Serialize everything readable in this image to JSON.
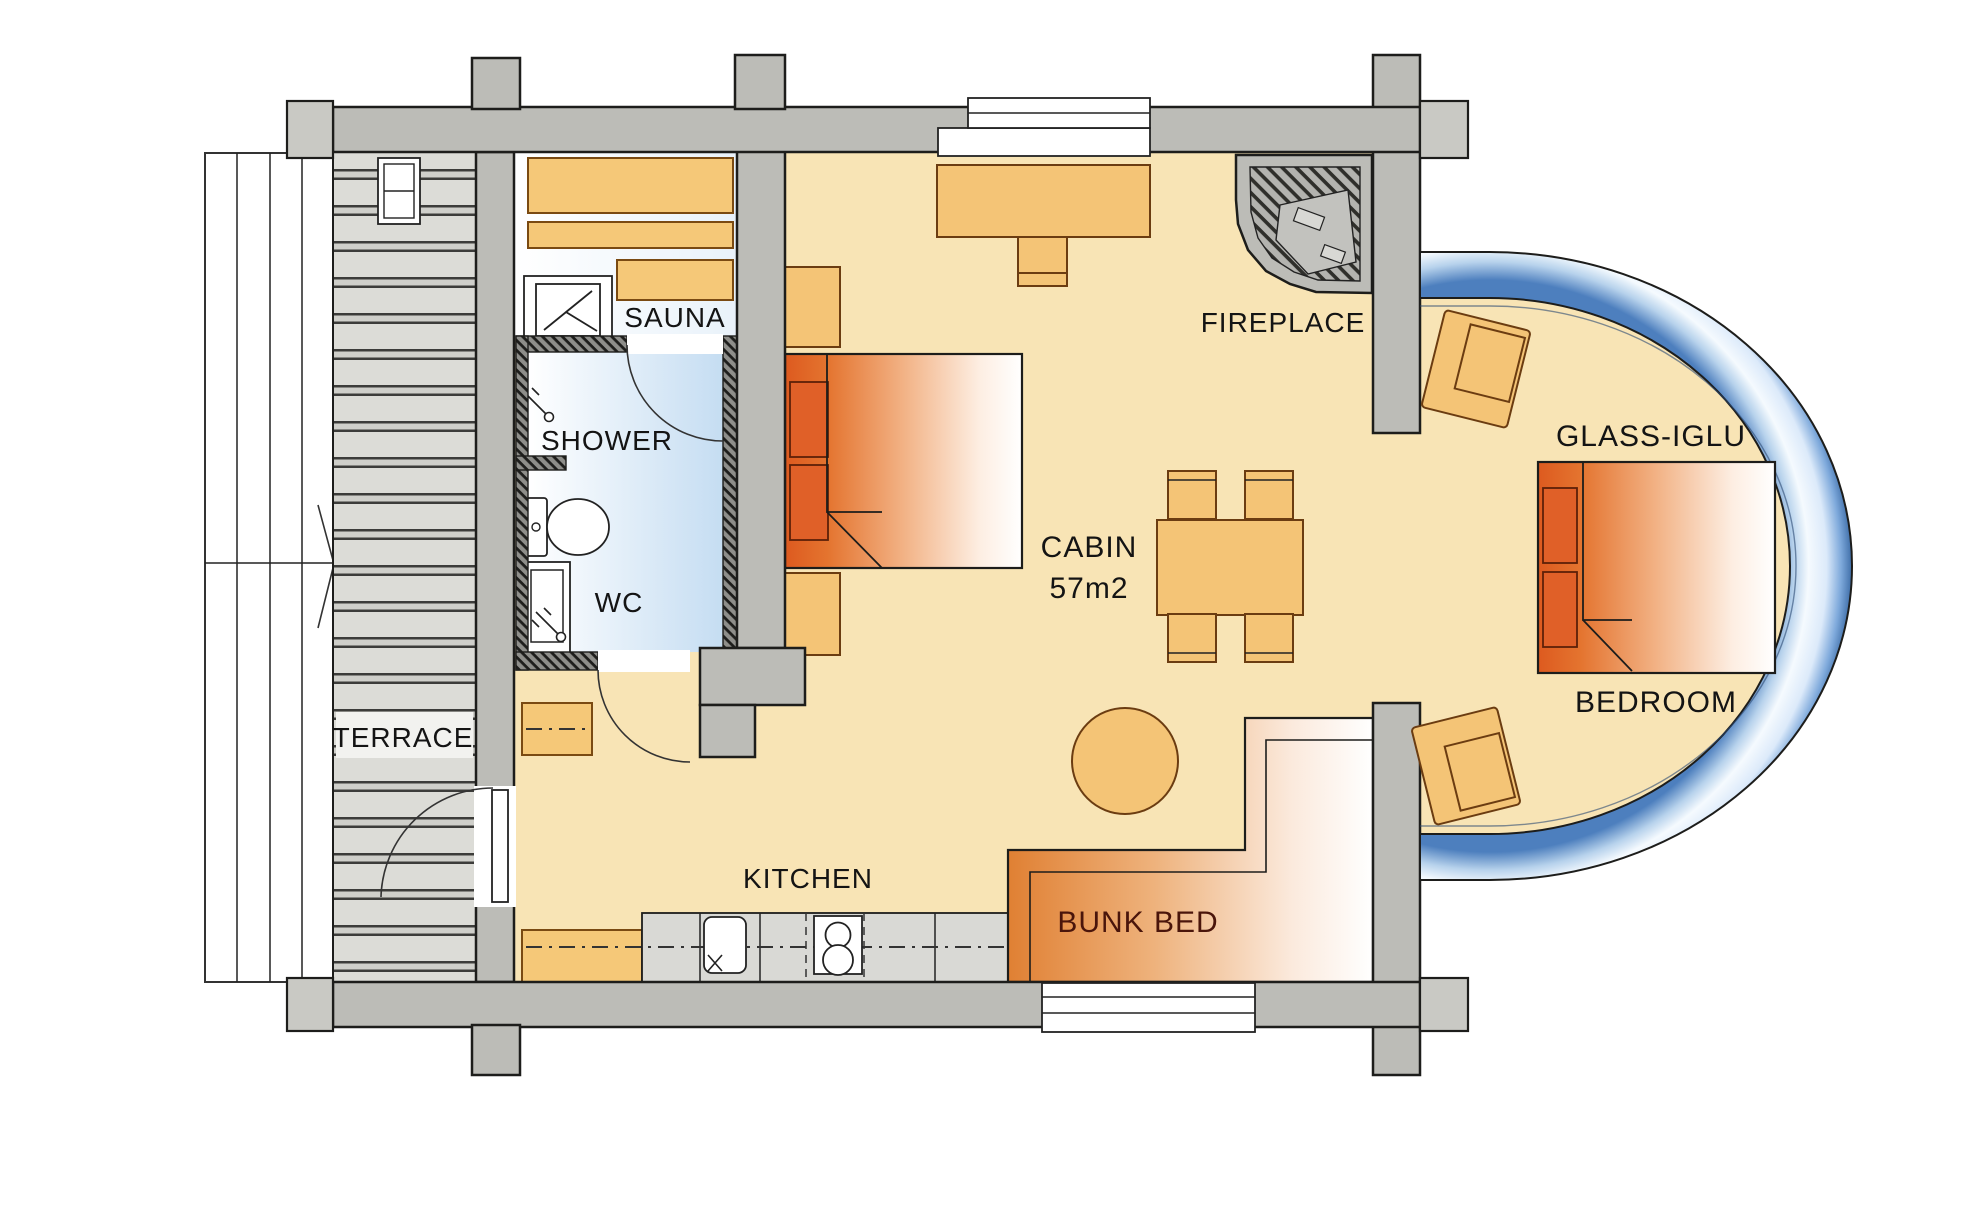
{
  "title": "Log cabin floor plan",
  "palette": {
    "wall": "#bcbcb7",
    "wallcap": "#c9c9c4",
    "outline": "#1d1d1b",
    "floor": "#f8e4b5",
    "terrace_plank": "#dcdcd7",
    "counter": "#d9d9d5",
    "furniture": "#f4c476",
    "benchwood": "#f5c878",
    "bathroom_blue": "#cfe4f5",
    "glass_blue": "#4d7fbe",
    "bed_orange": "#df5c20",
    "bunktext": "#4a150b",
    "label": "#141414"
  },
  "rooms": {
    "cabin_area_value": "57m2"
  },
  "labels": {
    "sauna": "SAUNA",
    "shower": "SHOWER",
    "wc": "WC",
    "terrace": "TERRACE",
    "kitchen": "KITCHEN",
    "cabin_name": "CABIN",
    "cabin_area": "57m2",
    "fireplace": "FIREPLACE",
    "glass_iglu": "GLASS-IGLU",
    "bedroom": "BEDROOM",
    "bunk_bed": "BUNK BED"
  }
}
